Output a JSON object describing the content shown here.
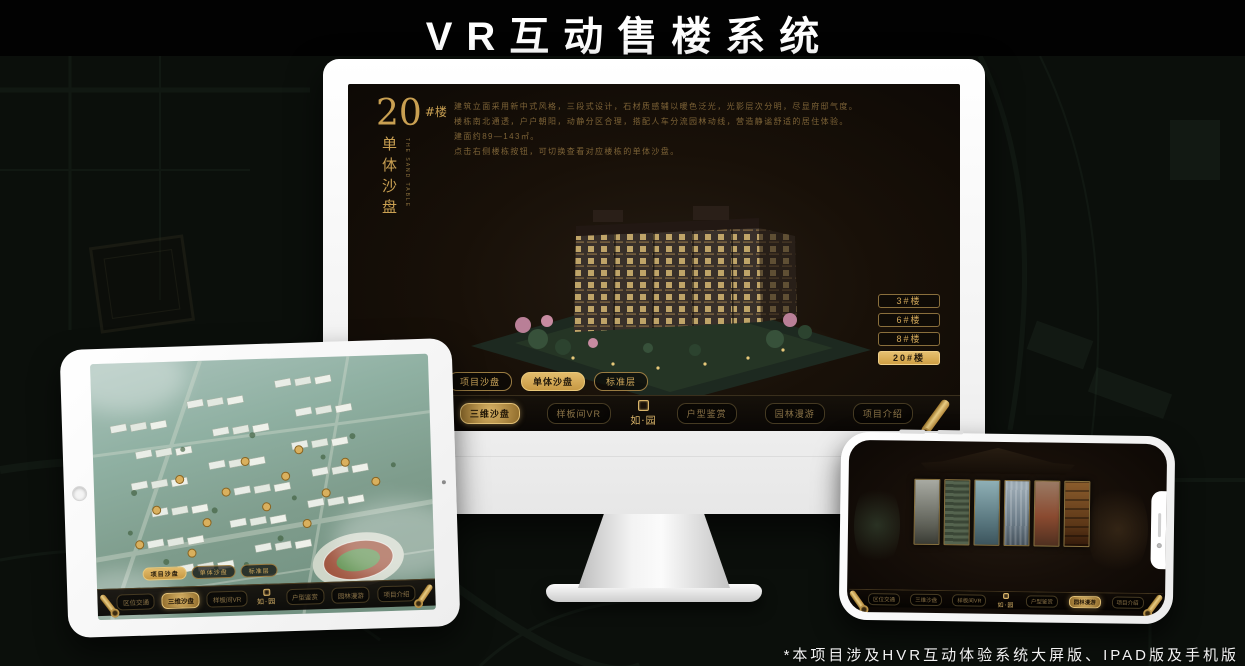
{
  "page": {
    "title": "VR互动售楼系统",
    "footnote": "*本项目涉及HVR互动体验系统大屏版、IPAD版及手机版"
  },
  "colors": {
    "accent_gold": "#c9a052",
    "active_gold_bg": "#d9ae5e",
    "screen_bg": "#17110b"
  },
  "brand": "如·园",
  "desktop": {
    "headline": {
      "number": "20",
      "suffix": "#楼",
      "sub": "单体沙盘",
      "caption": "THE SAND TABLE"
    },
    "description_lines": [
      "建筑立面采用新中式风格，三段式设计，石材质感辅以暖色泛光，光影层次分明，尽显府邸气度。",
      "楼栋南北通透，户户朝阳，动静分区合理，搭配人车分流园林动线，营造静谧舒适的居住体验。",
      "建面约89—143㎡。",
      "点击右侧楼栋按钮，可切换查看对应楼栋的单体沙盘。"
    ],
    "building_buttons": [
      {
        "label": "3#楼",
        "active": false
      },
      {
        "label": "6#楼",
        "active": false
      },
      {
        "label": "8#楼",
        "active": false
      },
      {
        "label": "20#楼",
        "active": true
      }
    ],
    "mode_tabs": [
      {
        "label": "项目沙盘",
        "active": false
      },
      {
        "label": "单体沙盘",
        "active": true
      },
      {
        "label": "标准层",
        "active": false
      }
    ],
    "nav_left": [
      {
        "label": "区位交通",
        "active": false
      },
      {
        "label": "三维沙盘",
        "active": true
      },
      {
        "label": "样板间VR",
        "active": false
      }
    ],
    "nav_right": [
      {
        "label": "户型鉴赏",
        "active": false
      },
      {
        "label": "园林漫游",
        "active": false
      },
      {
        "label": "项目介绍",
        "active": false
      }
    ]
  },
  "tablet": {
    "mode_tabs": [
      {
        "label": "项目沙盘",
        "active": true
      },
      {
        "label": "单体沙盘",
        "active": false
      },
      {
        "label": "标准层",
        "active": false
      }
    ],
    "nav_left": [
      {
        "label": "区位交通",
        "active": false
      },
      {
        "label": "三维沙盘",
        "active": true
      },
      {
        "label": "样板间VR",
        "active": false
      }
    ],
    "nav_right": [
      {
        "label": "户型鉴赏",
        "active": false
      },
      {
        "label": "园林漫游",
        "active": false
      },
      {
        "label": "项目介绍",
        "active": false
      }
    ]
  },
  "phone": {
    "nav_left": [
      {
        "label": "区位交通",
        "active": false
      },
      {
        "label": "三维沙盘",
        "active": false
      },
      {
        "label": "样板间VR",
        "active": false
      }
    ],
    "nav_right": [
      {
        "label": "户型鉴赏",
        "active": false
      },
      {
        "label": "园林漫游",
        "active": true
      },
      {
        "label": "项目介绍",
        "active": false
      }
    ]
  }
}
